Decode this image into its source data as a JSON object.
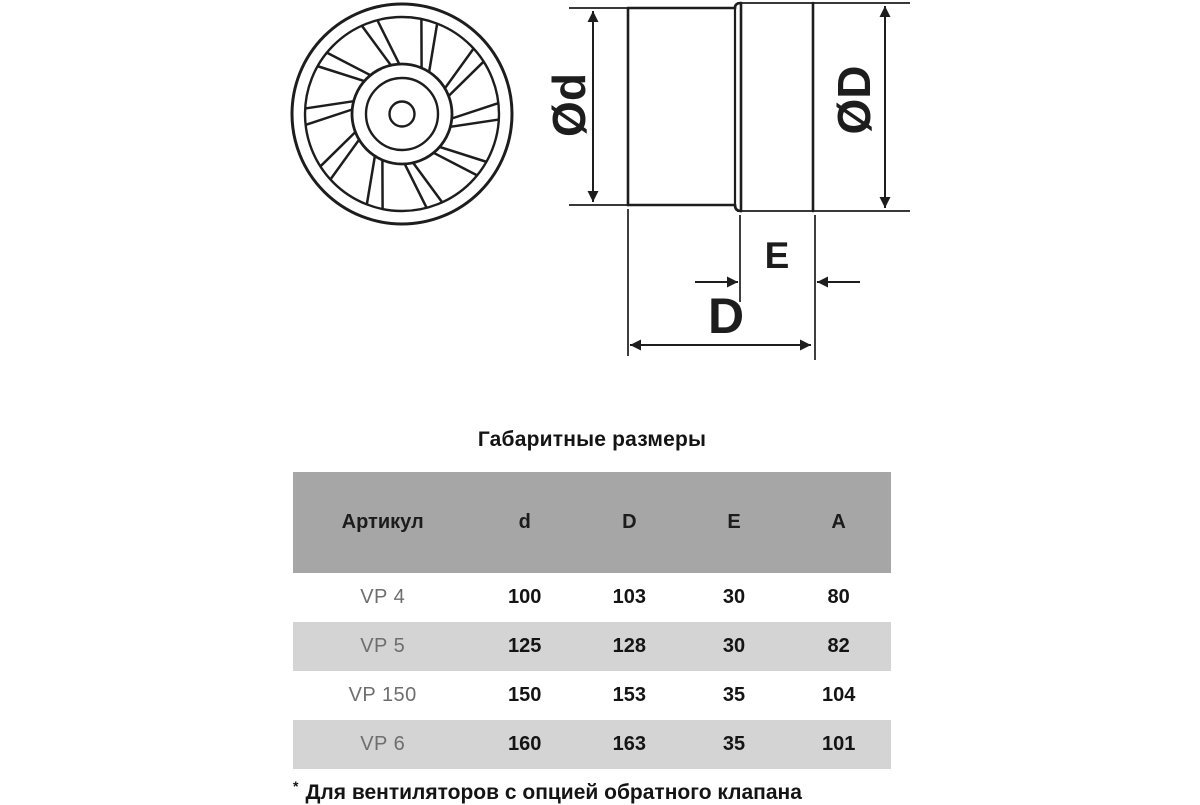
{
  "drawing": {
    "front_view": {
      "name": "axial-fan-front-view",
      "blade_count": 10
    },
    "side_view_labels": {
      "small_diameter": "Ød",
      "large_diameter": "ØD",
      "flange_depth": "E",
      "total_depth": "D"
    }
  },
  "table": {
    "title": "Габаритные размеры",
    "columns": [
      "Артикул",
      "d",
      "D",
      "E",
      "A"
    ],
    "rows": [
      {
        "article": "VP 4",
        "d": "100",
        "D": "103",
        "E": "30",
        "A": "80"
      },
      {
        "article": "VP 5",
        "d": "125",
        "D": "128",
        "E": "30",
        "A": "82"
      },
      {
        "article": "VP 150",
        "d": "150",
        "D": "153",
        "E": "35",
        "A": "104"
      },
      {
        "article": "VP 6",
        "d": "160",
        "D": "163",
        "E": "35",
        "A": "101"
      }
    ]
  },
  "footnote": {
    "marker": "*",
    "text": "Для вентиляторов с опцией обратного клапана"
  },
  "colors": {
    "header_bg": "#a6a6a6",
    "stripe_bg": "#d4d4d4",
    "ink": "#1d1d1d",
    "muted_text": "#6e6e6e"
  }
}
